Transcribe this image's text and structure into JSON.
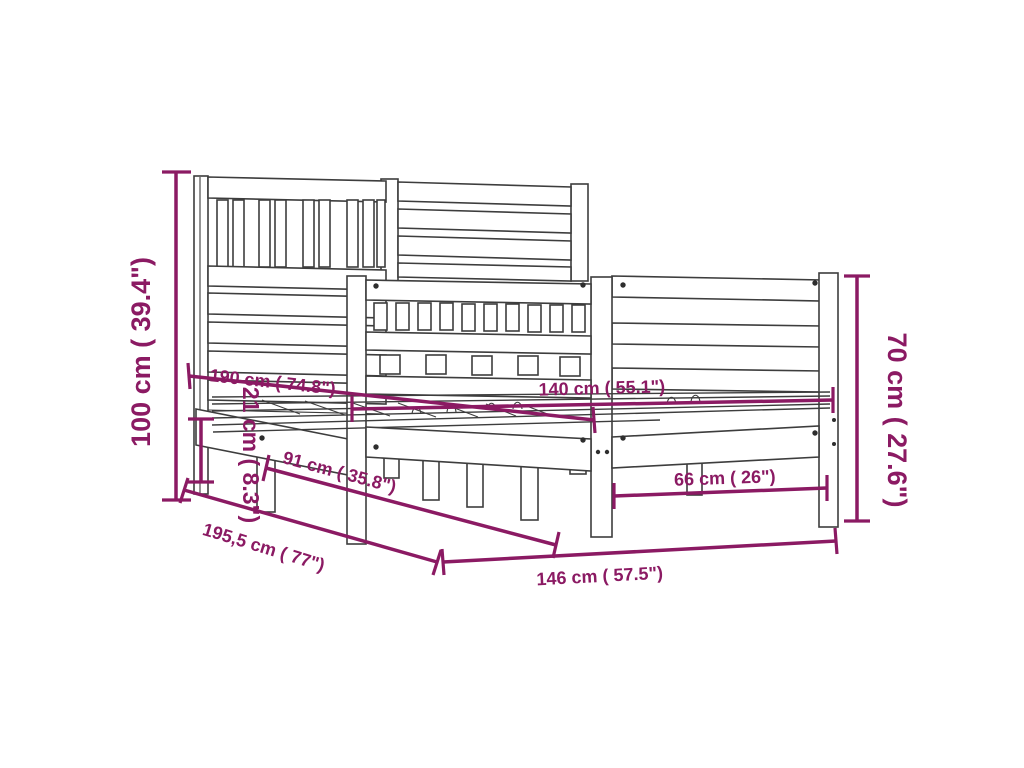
{
  "diagram": {
    "title": "Bed frame dimension drawing",
    "background_color": "#ffffff",
    "drawing_line_color": "#3d3d3d",
    "dimension_color": "#8b1a63",
    "dimensions": [
      {
        "name": "headboard-height",
        "label": "100 cm ( 39.4\")"
      },
      {
        "name": "mattress-length",
        "label": "190 cm ( 74.8\")"
      },
      {
        "name": "side-rail-height",
        "label": "21 cm ( 8.3\")"
      },
      {
        "name": "side-leg-spacing",
        "label": "91 cm ( 35.8\")"
      },
      {
        "name": "frame-length",
        "label": "195,5 cm ( 77\")"
      },
      {
        "name": "mattress-width",
        "label": "140 cm ( 55.1\")"
      },
      {
        "name": "foot-leg-spacing",
        "label": "66 cm ( 26\")"
      },
      {
        "name": "frame-width",
        "label": "146 cm ( 57.5\")"
      },
      {
        "name": "footboard-height",
        "label": "70 cm ( 27.6\")"
      }
    ]
  }
}
